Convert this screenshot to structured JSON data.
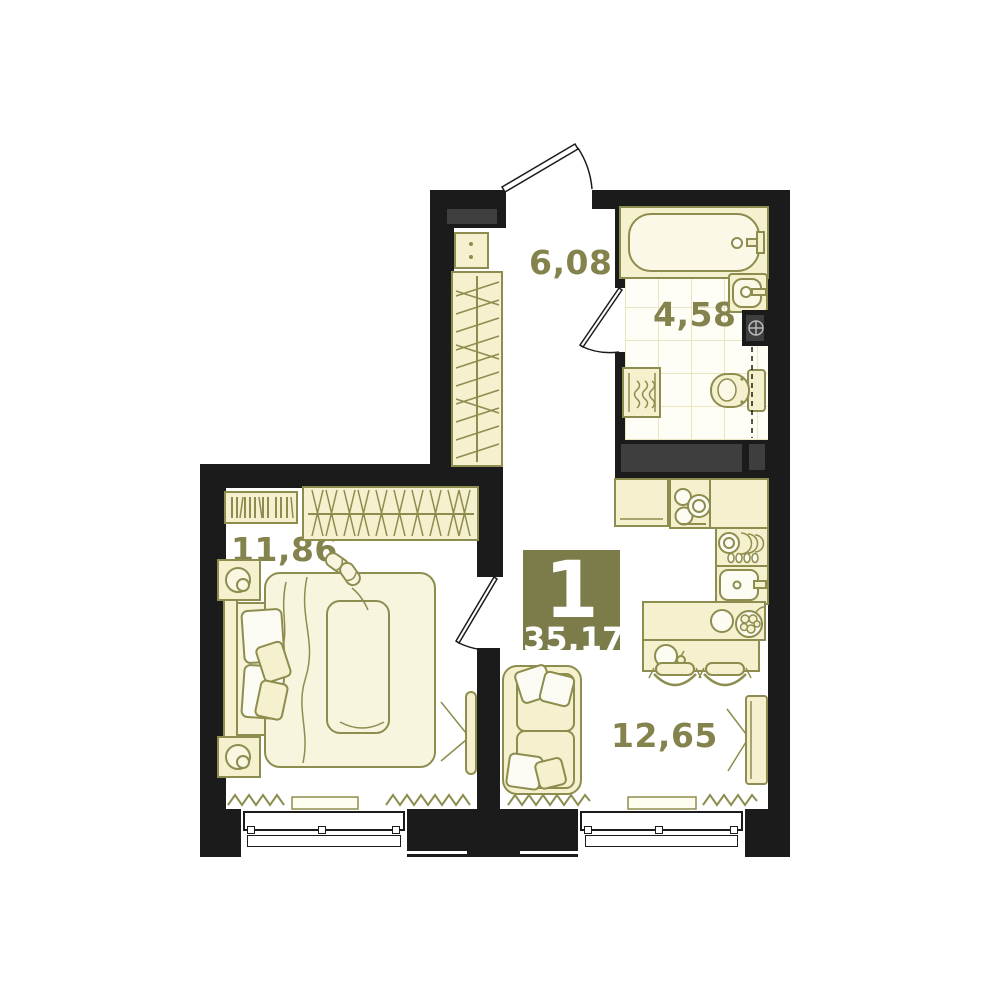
{
  "badge": {
    "room_count": "1",
    "total_area": "35,17"
  },
  "rooms": {
    "hallway": {
      "area": "6,08"
    },
    "bathroom": {
      "area": "4,58"
    },
    "bedroom": {
      "area": "11,86"
    },
    "living_kitchen": {
      "area": "12,65"
    }
  },
  "kitchen": {
    "fridge_label": "***"
  },
  "colors": {
    "wall": "#1b1b1b",
    "furniture_fill": "#f5f0cd",
    "furniture_outline": "#8d8d4f",
    "label_text": "#85834d",
    "badge_background": "#7c7c4a",
    "badge_text": "#ffffff",
    "shaft_gray": "#3e3e3e",
    "tile_line": "#ece5c2"
  }
}
